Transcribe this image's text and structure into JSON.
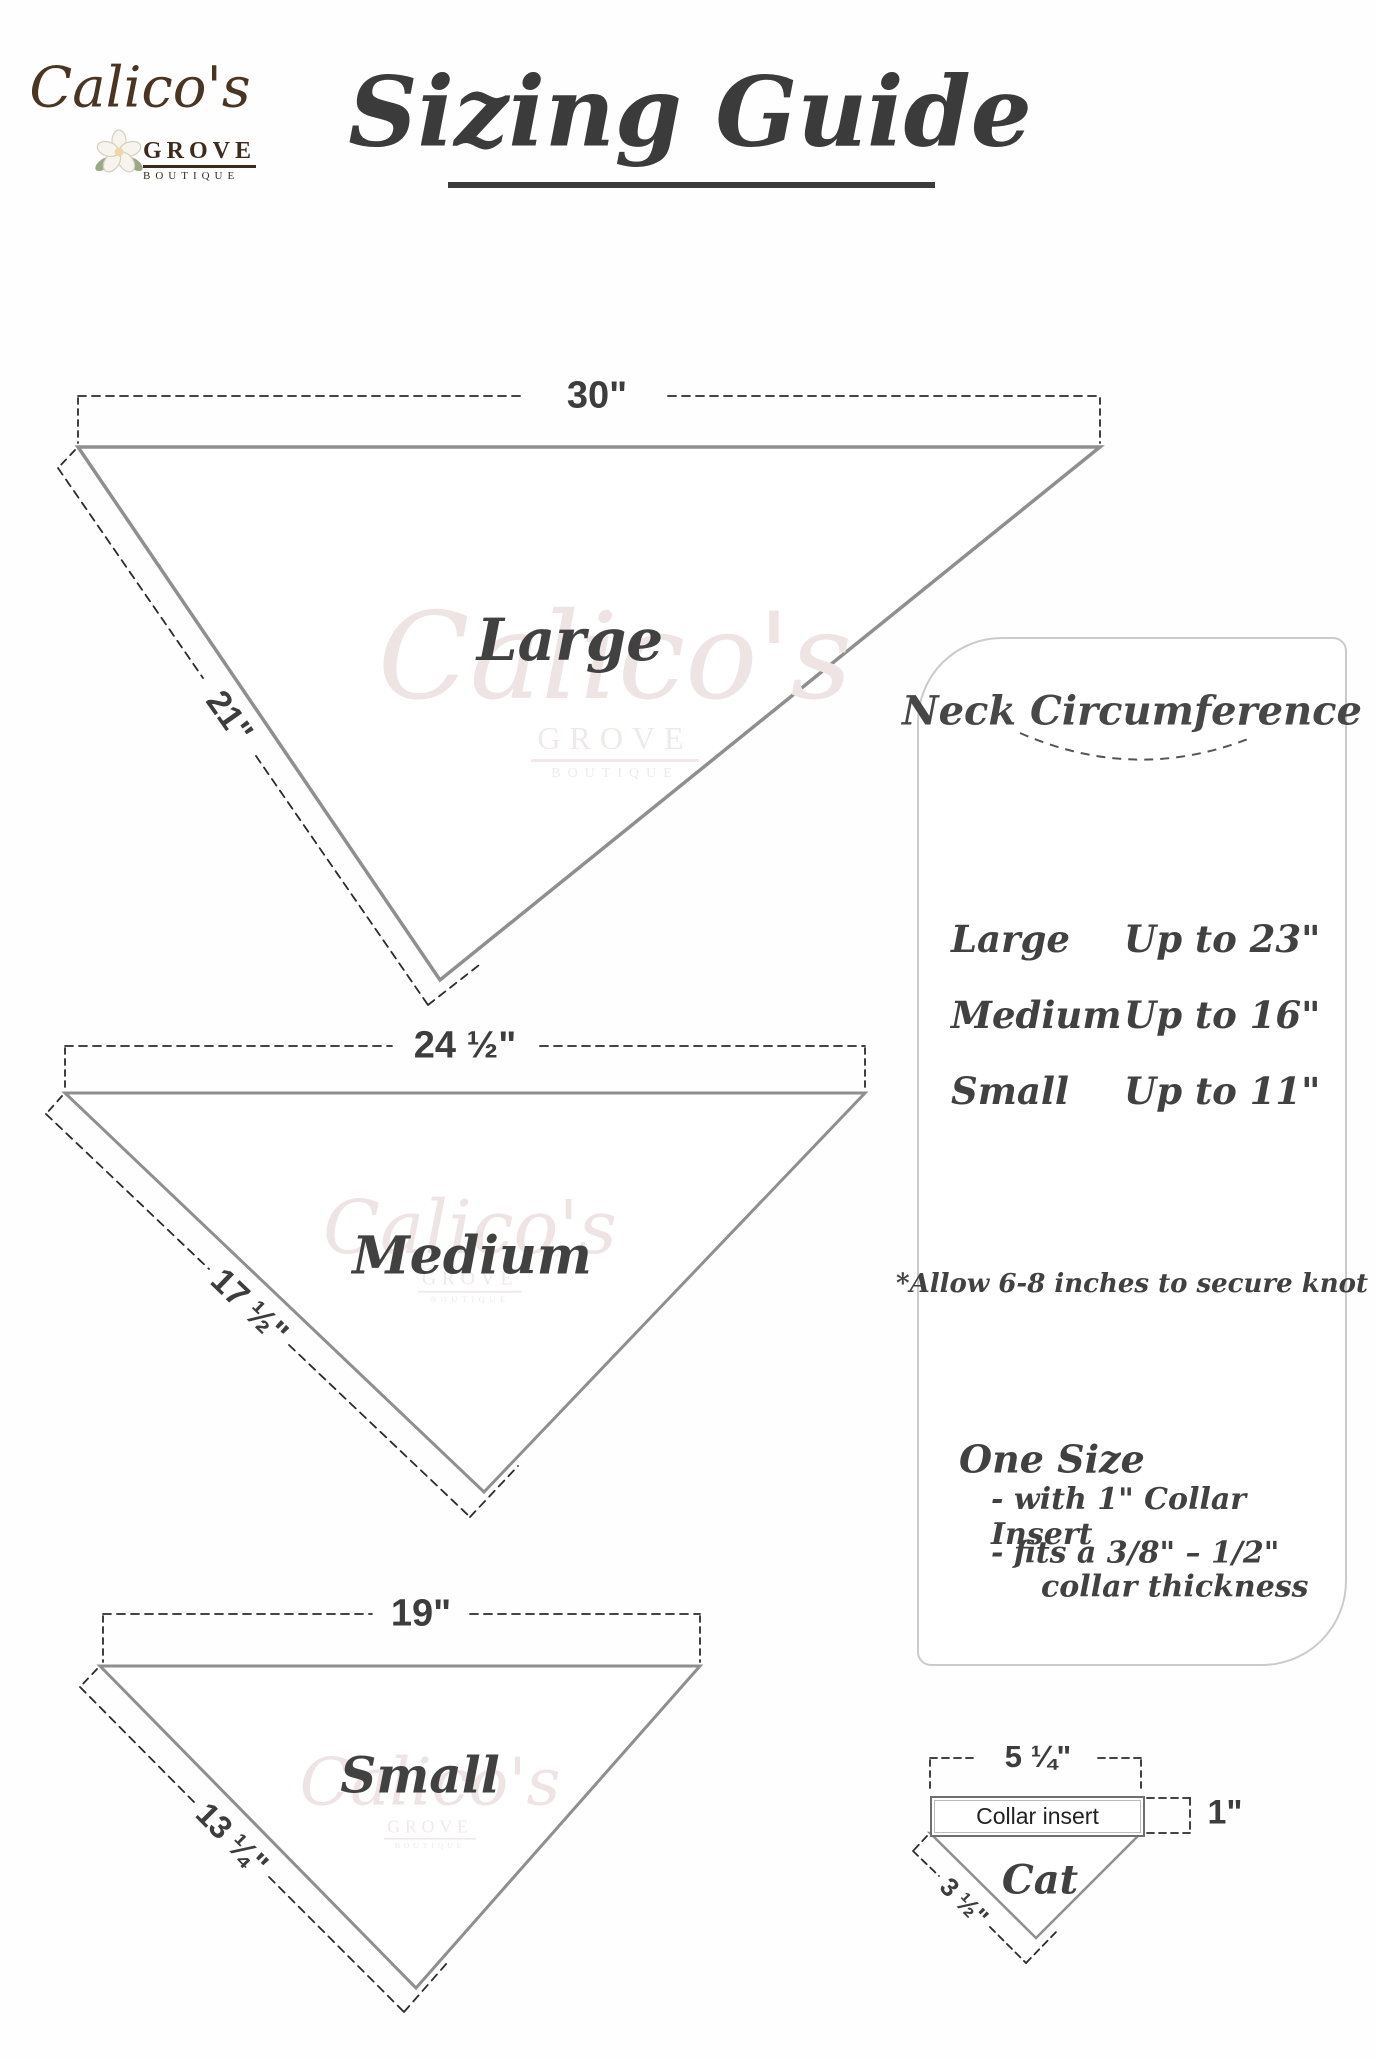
{
  "logo": {
    "name": "Calico's",
    "grove": "GROVE",
    "boutique": "BOUTIQUE"
  },
  "title": {
    "text": "Sizing Guide"
  },
  "watermark": {
    "name": "Calico's",
    "grove": "GROVE",
    "boutique": "BOUTIQUE"
  },
  "triangles": [
    {
      "label": "Large",
      "top_width": "30\"",
      "side_length": "21\""
    },
    {
      "label": "Medium",
      "top_width": "24 ½\"",
      "side_length": "17 ½\""
    },
    {
      "label": "Small",
      "top_width": "19\"",
      "side_length": "13 ¼\""
    }
  ],
  "panel": {
    "title": "Neck Circumference",
    "sizes": [
      {
        "label": "Large",
        "value": "Up to 23\""
      },
      {
        "label": "Medium",
        "value": "Up to 16\""
      },
      {
        "label": "Small",
        "value": "Up to 11\""
      }
    ],
    "note": "*Allow 6-8 inches to secure knot",
    "one_size": {
      "title": "One Size",
      "line1": "- with 1\" Collar Insert",
      "line2": "- fits a 3/8\" – 1/2\"",
      "line3": "collar thickness"
    }
  },
  "cat_diagram": {
    "width_label": "5 ¼\"",
    "insert_label": "Collar insert",
    "height_label": "1\"",
    "side_label": "3 ½\"",
    "name_label": "Cat"
  },
  "colors": {
    "edge_gray": "#8f8f8f",
    "dash_dark": "#2b2b2b",
    "text_dark": "#3d3d3d",
    "panel_border": "#cbcbcb",
    "brand_brown": "#4a3422",
    "watermark_pink": "#efe4e4"
  }
}
